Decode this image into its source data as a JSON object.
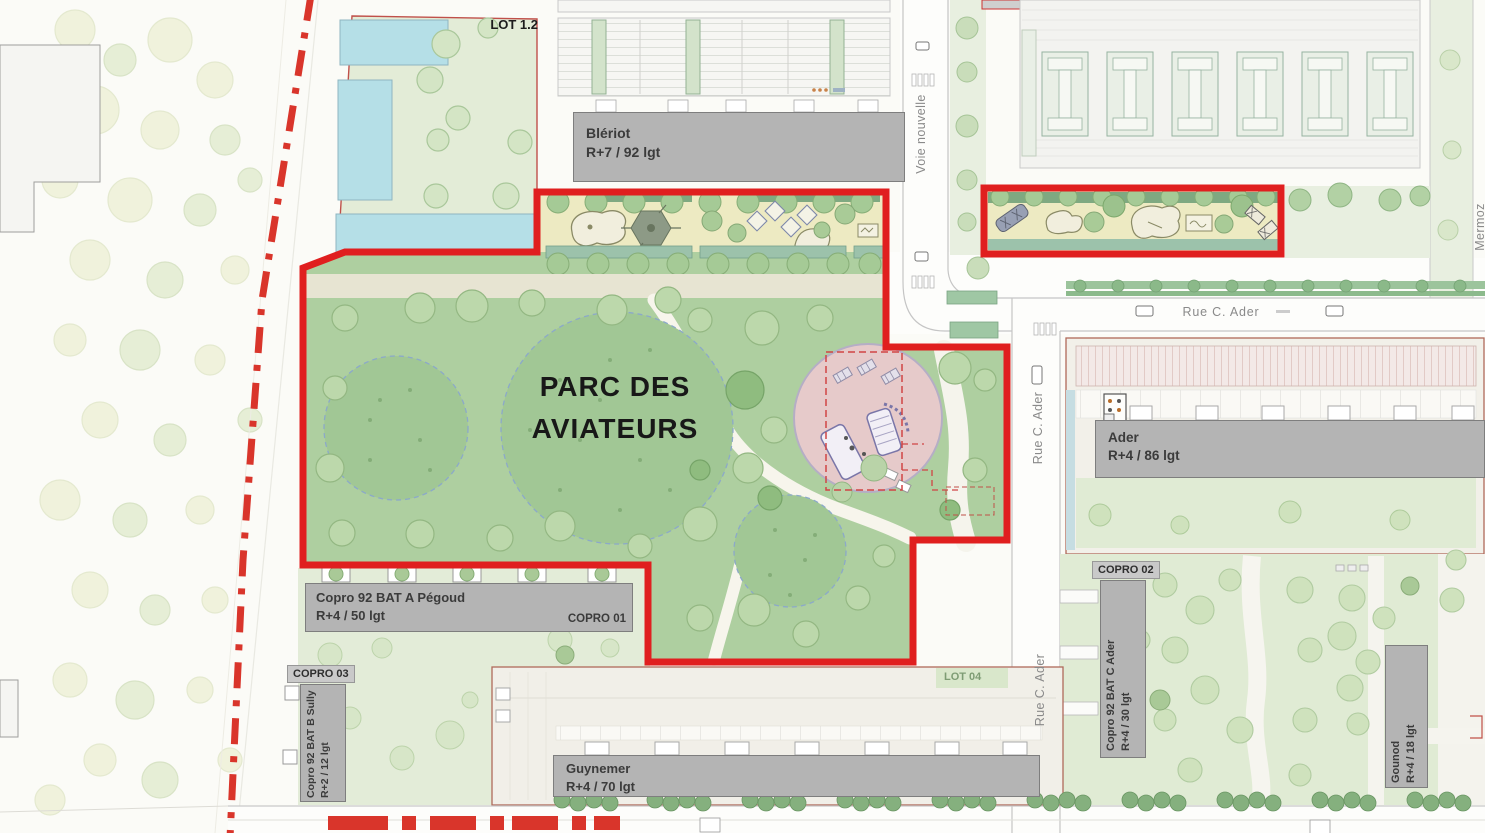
{
  "park": {
    "title": "PARC DES AVIATEURS"
  },
  "lots": {
    "lot_1_2": "LOT 1.2",
    "lot_04": "LOT 04",
    "copro_01": "COPRO 01",
    "copro_02": "COPRO 02",
    "copro_03": "COPRO 03"
  },
  "buildings": {
    "bleriot": {
      "name": "Blériot",
      "spec": "R+7 / 92 lgt"
    },
    "ader": {
      "name": "Ader",
      "spec": "R+4 / 86 lgt"
    },
    "pegoud": {
      "name": "Copro 92 BAT A Pégoud",
      "spec": "R+4 / 50 lgt"
    },
    "sully": {
      "name": "Copro 92 BAT B Sully",
      "spec": "R+2 / 12 lgt"
    },
    "bat_c_ader": {
      "name": "Copro 92 BAT C Ader",
      "spec": "R+4 / 30 lgt"
    },
    "guynemer": {
      "name": "Guynemer",
      "spec": "R+4 / 70 lgt"
    },
    "gounod": {
      "name": "Gounod",
      "spec": "R+4 / 18 lgt"
    }
  },
  "streets": {
    "voie_nouvelle": "Voie nouvelle",
    "rue_c_ader": "Rue C. Ader",
    "mermoz": "Mermoz"
  },
  "colors": {
    "boundary_red": "#e01f1f",
    "dashdot_red": "#d9352b",
    "park_green": "#aecfa0",
    "playground_yellow": "#edeac2",
    "water_blue": "#b5dfe7",
    "building_grey": "#b3b3b3",
    "playground_pink": "#e6caca",
    "lot_border_red": "#b06a5a",
    "street_text_grey": "#8a8a8a"
  }
}
